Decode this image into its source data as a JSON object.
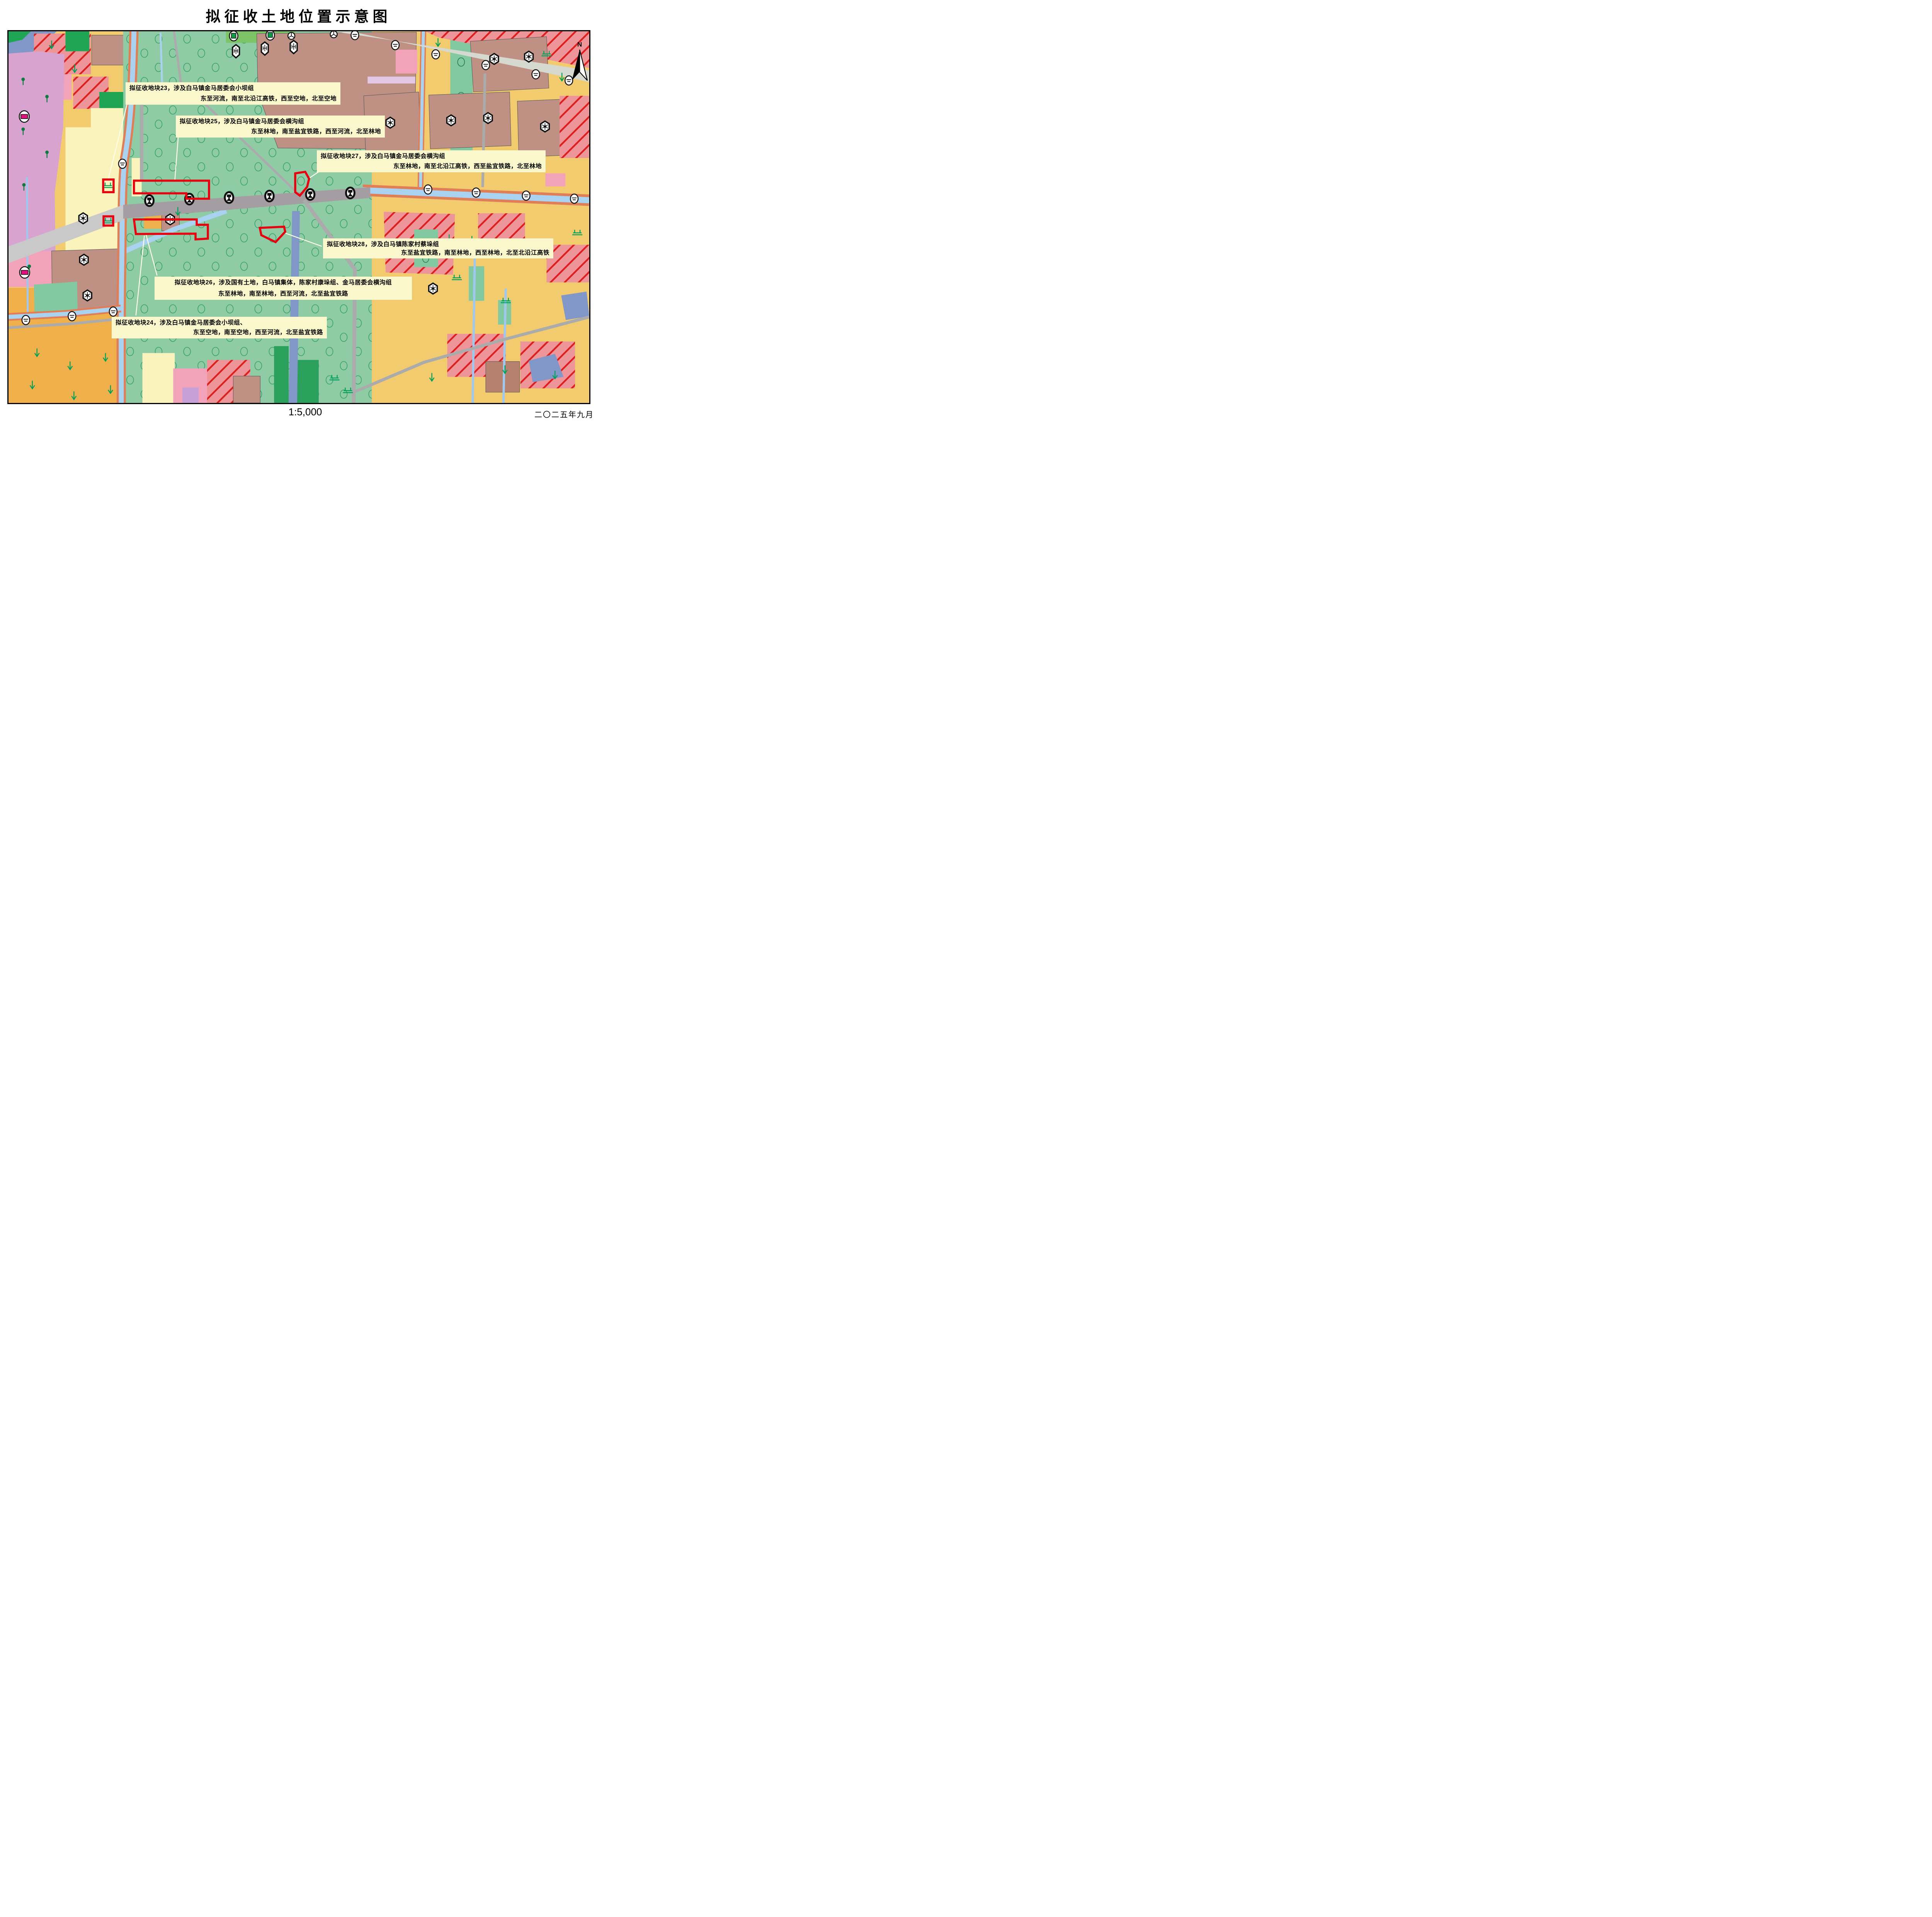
{
  "title": "拟征收土地位置示意图",
  "north_label": "N",
  "footer": {
    "scale": "1:5,000",
    "date": "二〇二五年九月"
  },
  "labels": {
    "p23": {
      "line1": "拟征收地块23，涉及白马镇金马居委会小坝组",
      "line2": "东至河流，南至北沿江高铁，西至空地，北至空地"
    },
    "p25": {
      "line1": "拟征收地块25，涉及白马镇金马居委会横沟组",
      "line2": "东至林地，南至盐宜铁路，西至河流，北至林地"
    },
    "p27": {
      "line1": "拟征收地块27，涉及白马镇金马居委会横沟组",
      "line2": "东至林地，南至北沿江高铁，西至盐宜铁路，北至林地"
    },
    "p28": {
      "line1": "拟征收地块28，涉及白马镇陈家村蔡垛组",
      "line2": "东至盐宜铁路，南至林地，西至林地，北至北沿江高铁"
    },
    "p26": {
      "line1": "拟征收地块26，涉及国有土地，白马镇集体，陈家村康垛组、金马居委会横沟组",
      "line2": "东至林地，南至林地，西至河流，北至盐宜铁路"
    },
    "p24": {
      "line1": "拟征收地块24，涉及白马镇金马居委会小坝组、",
      "line2": "东至空地，南至空地，西至河流，北至盐宜铁路"
    }
  },
  "palette": {
    "forest_green": "#8FCBA5",
    "forest_circle": "#2F9E62",
    "dark_green": "#2BA05C",
    "bright_green": "#1FA554",
    "mid_green": "#7CC466",
    "teal_green": "#82C9A1",
    "farm_yellow": "#F2CB6E",
    "deep_yellow": "#EFAF4B",
    "cream": "#FBF3BC",
    "violet_pink": "#D9A3D0",
    "rose_pink": "#F2A3BA",
    "lilac": "#E2C7E4",
    "purple": "#C8A0D8",
    "village_brown": "#BF9084",
    "brown_dark": "#B5826F",
    "hatch_bg": "#EE959A",
    "hatch_line": "#DC1F1F",
    "river_blue": "#A8D2F0",
    "slate_blue": "#8097C8",
    "pale_blue": "#A0C8EE",
    "road_salmon": "#E07E58",
    "road_gray": "#ABABAB",
    "road_sage": "#D5D9CF",
    "rail_gray": "#A49DA2",
    "hsr_gray": "#C9C9C9",
    "parcel_red": "#E8000F",
    "label_bg": "#FBF7CD",
    "leader": "#FFFDE8",
    "symbol_green": "#00A05A",
    "tree_green": "#0E7A42",
    "magenta": "#E0107E"
  },
  "icons": {
    "north-arrow-icon": "half-filled north arrow with N",
    "railway-icon": "black ellipse with rail profile (高铁/铁路)",
    "bridge-icon": "white ellipse road symbol",
    "hexagon-settlement-icon": "white hexagon with starburst",
    "shield-icon": "elongated white hexagon village symbol",
    "park-icon": "white ellipse with green square",
    "kindergarten-icon": "white ellipse with magenta rectangle",
    "circle-sector-icon": "white circle with radial spokes",
    "orchard-circle-icon": "green outlined ellipse (林地/园地)",
    "grass-arrow-icon": "green down arrow (耕地)",
    "irrigated-field-icon": "green double-T field symbol",
    "tree-icon": "green lollipop tree"
  }
}
